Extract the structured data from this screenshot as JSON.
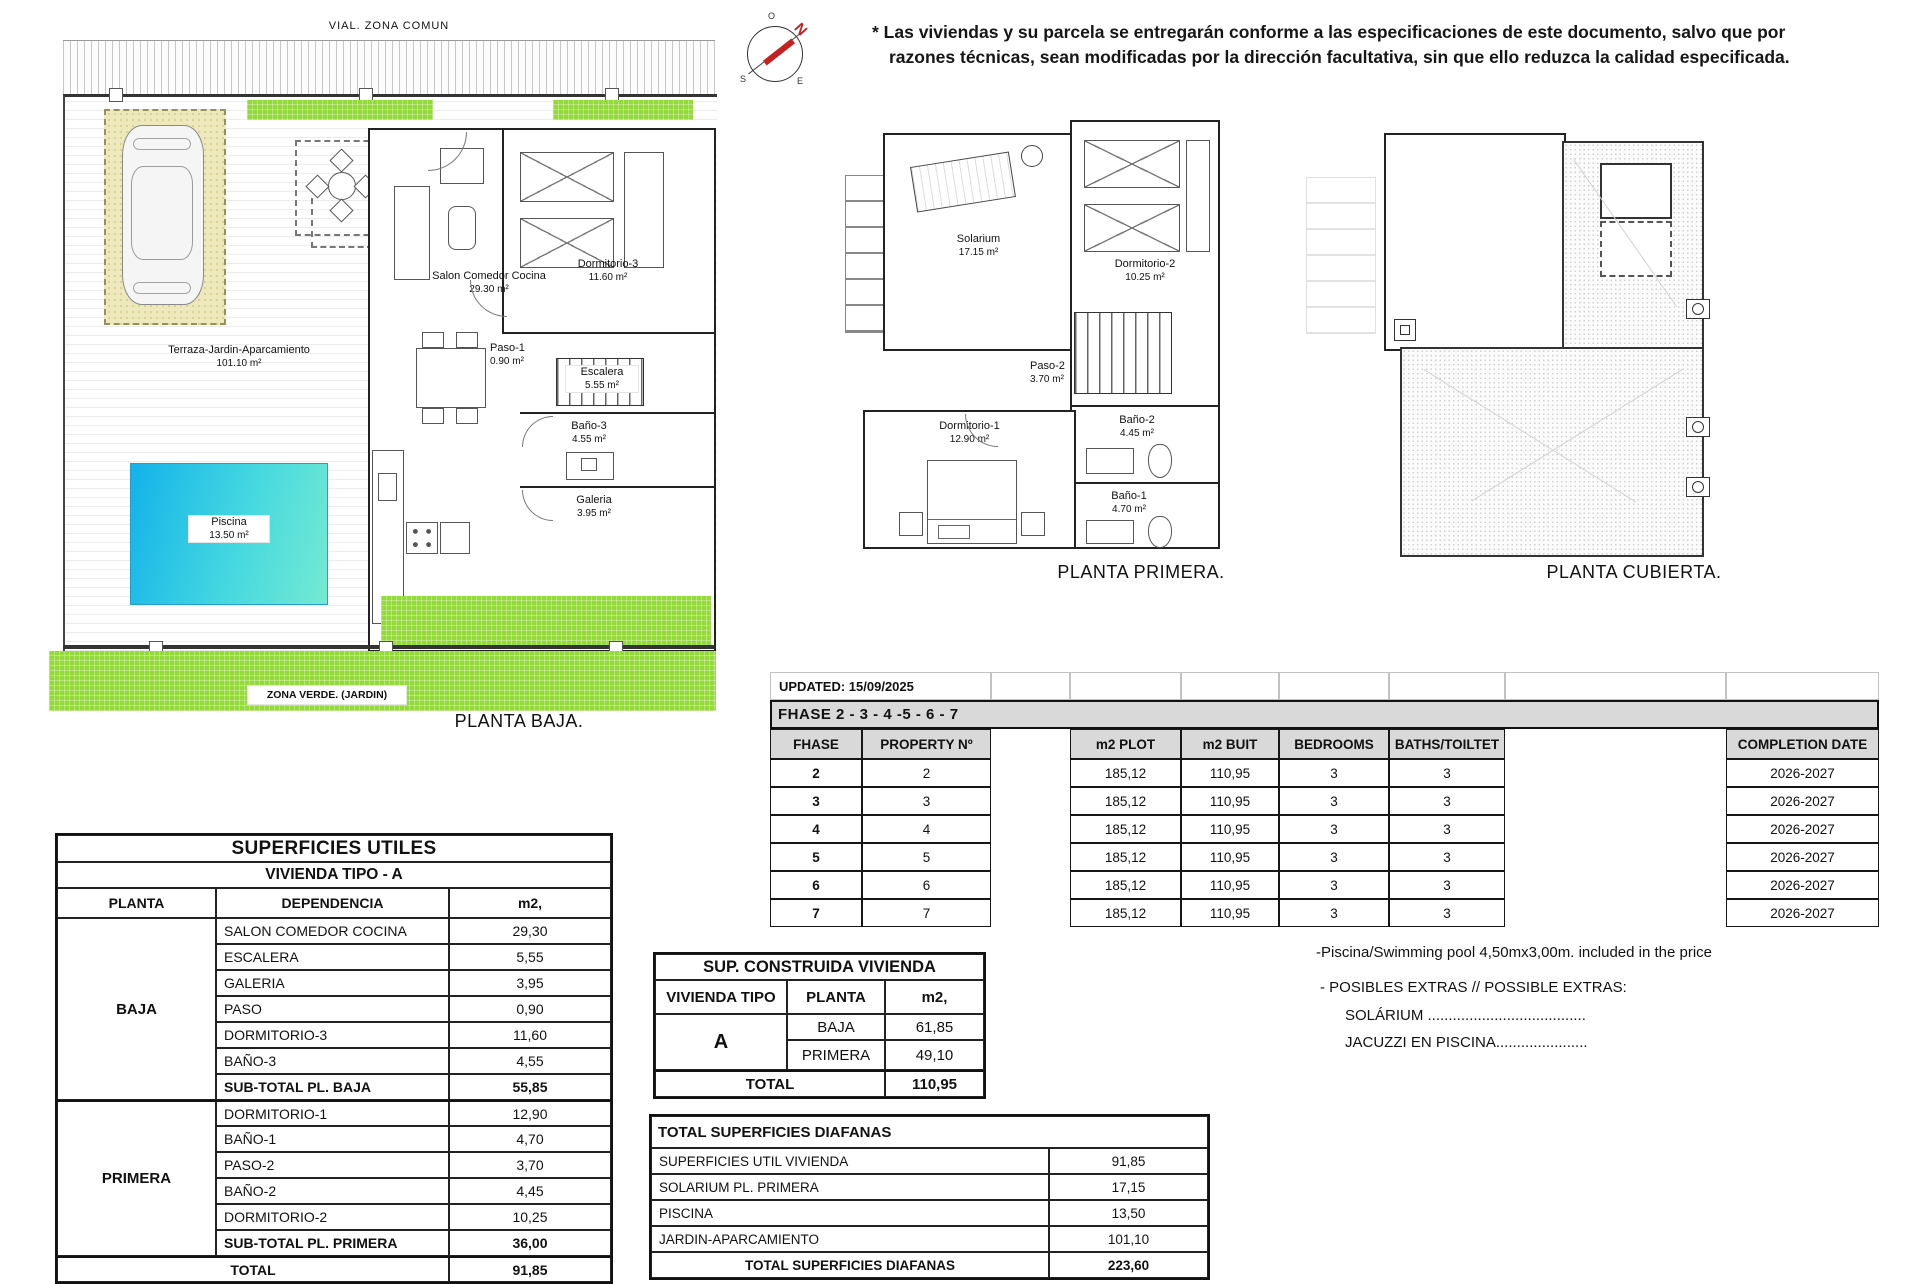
{
  "disclaimer": {
    "line1": "* Las viviendas y su parcela se entregarán conforme a las especificaciones de este documento, salvo que por",
    "line2": "razones técnicas, sean modificadas por la dirección facultativa, sin que ello reduzca la calidad especificada."
  },
  "compass": {
    "north": "N",
    "top": "O",
    "bottom_left": "S",
    "bottom_right": "E"
  },
  "plan_baja": {
    "title": "PLANTA BAJA.",
    "road_label": "VIAL. ZONA COMUN",
    "zona_verde": "ZONA VERDE. (JARDIN)",
    "terraza": {
      "name": "Terraza-Jardin-Aparcamiento",
      "area": "101.10 m²"
    },
    "piscina": {
      "name": "Piscina",
      "area": "13.50 m²"
    },
    "salon": {
      "name": "Salon Comedor Cocina",
      "area": "29.30 m²"
    },
    "dormitorio3": {
      "name": "Dormitorio-3",
      "area": "11.60 m²"
    },
    "paso1": {
      "name": "Paso-1",
      "area": "0.90 m²"
    },
    "escalera": {
      "name": "Escalera",
      "area": "5.55 m²"
    },
    "bano3": {
      "name": "Baño-3",
      "area": "4.55 m²"
    },
    "galeria": {
      "name": "Galeria",
      "area": "3.95 m²"
    }
  },
  "plan_primera": {
    "title": "PLANTA PRIMERA.",
    "solarium": {
      "name": "Solarium",
      "area": "17.15 m²"
    },
    "dormitorio1": {
      "name": "Dormitorio-1",
      "area": "12.90 m²"
    },
    "dormitorio2": {
      "name": "Dormitorio-2",
      "area": "10.25 m²"
    },
    "paso2": {
      "name": "Paso-2",
      "area": "3.70 m²"
    },
    "bano2": {
      "name": "Baño-2",
      "area": "4.45 m²"
    },
    "bano1": {
      "name": "Baño-1",
      "area": "4.70 m²"
    }
  },
  "plan_cubierta": {
    "title": "PLANTA CUBIERTA."
  },
  "phase_table": {
    "updated": "UPDATED: 15/09/2025",
    "band": "FHASE  2 - 3 - 4 -5 - 6 - 7",
    "col_fhase": "FHASE",
    "col_property": "PROPERTY Nº",
    "col_plot": "m2 PLOT",
    "col_built": "m2 BUIT",
    "col_bedrooms": "BEDROOMS",
    "col_baths": "BATHS/TOILTET",
    "col_completion": "COMPLETION DATE",
    "rows": [
      {
        "fhase": "2",
        "property": "2",
        "plot": "185,12",
        "built": "110,95",
        "bedrooms": "3",
        "baths": "3",
        "completion": "2026-2027"
      },
      {
        "fhase": "3",
        "property": "3",
        "plot": "185,12",
        "built": "110,95",
        "bedrooms": "3",
        "baths": "3",
        "completion": "2026-2027"
      },
      {
        "fhase": "4",
        "property": "4",
        "plot": "185,12",
        "built": "110,95",
        "bedrooms": "3",
        "baths": "3",
        "completion": "2026-2027"
      },
      {
        "fhase": "5",
        "property": "5",
        "plot": "185,12",
        "built": "110,95",
        "bedrooms": "3",
        "baths": "3",
        "completion": "2026-2027"
      },
      {
        "fhase": "6",
        "property": "6",
        "plot": "185,12",
        "built": "110,95",
        "bedrooms": "3",
        "baths": "3",
        "completion": "2026-2027"
      },
      {
        "fhase": "7",
        "property": "7",
        "plot": "185,12",
        "built": "110,95",
        "bedrooms": "3",
        "baths": "3",
        "completion": "2026-2027"
      }
    ]
  },
  "superficies_utiles": {
    "title": "SUPERFICIES UTILES",
    "subtitle": "VIVIENDA TIPO - A",
    "col_planta": "PLANTA",
    "col_dependencia": "DEPENDENCIA",
    "col_m2": "m2,",
    "baja_label": "BAJA",
    "primera_label": "PRIMERA",
    "baja_rows": [
      [
        "SALON COMEDOR COCINA",
        "29,30"
      ],
      [
        "ESCALERA",
        "5,55"
      ],
      [
        "GALERIA",
        "3,95"
      ],
      [
        "PASO",
        "0,90"
      ],
      [
        "DORMITORIO-3",
        "11,60"
      ],
      [
        "BAÑO-3",
        "4,55"
      ]
    ],
    "baja_subtotal": [
      "SUB-TOTAL PL. BAJA",
      "55,85"
    ],
    "primera_rows": [
      [
        "DORMITORIO-1",
        "12,90"
      ],
      [
        "BAÑO-1",
        "4,70"
      ],
      [
        "PASO-2",
        "3,70"
      ],
      [
        "BAÑO-2",
        "4,45"
      ],
      [
        "DORMITORIO-2",
        "10,25"
      ]
    ],
    "primera_subtotal": [
      "SUB-TOTAL PL. PRIMERA",
      "36,00"
    ],
    "total_label": "TOTAL",
    "total_value": "91,85"
  },
  "sup_construida": {
    "title": "SUP. CONSTRUIDA VIVIENDA",
    "col_tipo": "VIVIENDA TIPO",
    "col_planta": "PLANTA",
    "col_m2": "m2,",
    "tipo": "A",
    "rows": [
      [
        "BAJA",
        "61,85"
      ],
      [
        "PRIMERA",
        "49,10"
      ]
    ],
    "total_label": "TOTAL",
    "total_value": "110,95"
  },
  "diafanas": {
    "title": "TOTAL SUPERFICIES DIAFANAS",
    "rows": [
      [
        "SUPERFICIES UTIL VIVIENDA",
        "91,85"
      ],
      [
        "SOLARIUM PL. PRIMERA",
        "17,15"
      ],
      [
        "PISCINA",
        "13,50"
      ],
      [
        "JARDIN-APARCAMIENTO",
        "101,10"
      ]
    ],
    "total_label": "TOTAL SUPERFICIES DIAFANAS",
    "total_value": "223,60"
  },
  "notes": {
    "pool": "-Piscina/Swimming pool 4,50mx3,00m. included in the price",
    "extras": "- POSIBLES EXTRAS // POSSIBLE EXTRAS:",
    "solarium": "SOLÁRIUM ......................................",
    "jacuzzi": "JACUZZI EN PISCINA......................"
  }
}
